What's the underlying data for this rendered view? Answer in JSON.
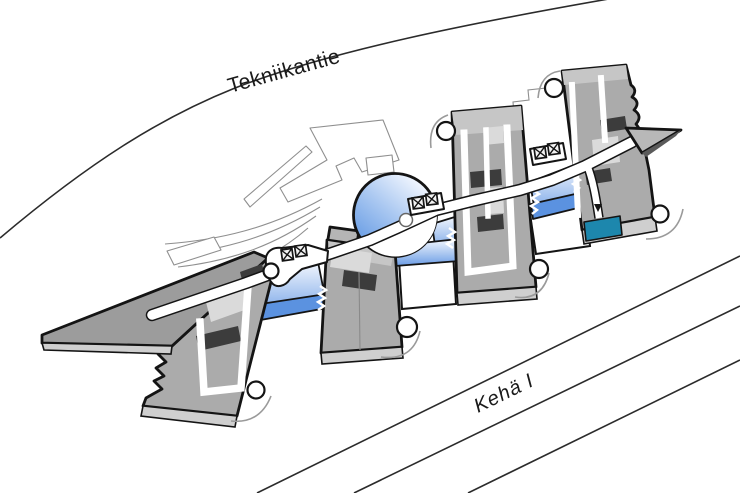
{
  "scene": {
    "description": "Axonometric site plan: a chain of grey building wings linked by a white spine corridor with blue glass atria and a round glass rotunda, set between two roads."
  },
  "roads": {
    "tekniikantie": {
      "label": "Tekniikantie"
    },
    "keha_i": {
      "label": "Kehä I",
      "lane_lines": 3
    }
  },
  "features": {
    "stair_icon_pairs": 3,
    "cylinder_towers": 6,
    "highlighted_entrance": true
  },
  "icons": {
    "stair_core_icon": "⊠⊠",
    "entrance_arrow_icon": "▼"
  },
  "colors": {
    "outline": "#141414",
    "road_line": "#2b2b2b",
    "context_line": "#8f8f8f",
    "building_roof": "#ababab",
    "building_roof_dark": "#9c9c9c",
    "building_cap": "#c6c6c6",
    "building_side": "#cfcfcf",
    "building_panel": "#dadada",
    "core_dark": "#3c3c3c",
    "wedge_shadow": "#5a5a5a",
    "glass_top": "#f3f7fe",
    "glass_mid": "#a9c6f0",
    "glass_deep": "#6b9ce6",
    "glass_band": "#5b92e0",
    "atrium_light": "#f4f8ff",
    "atrium_mid": "#aac8f1",
    "atrium_deep": "#5f97e3",
    "entrance_teal": "#1d87ad",
    "corridor_white": "#ffffff"
  }
}
